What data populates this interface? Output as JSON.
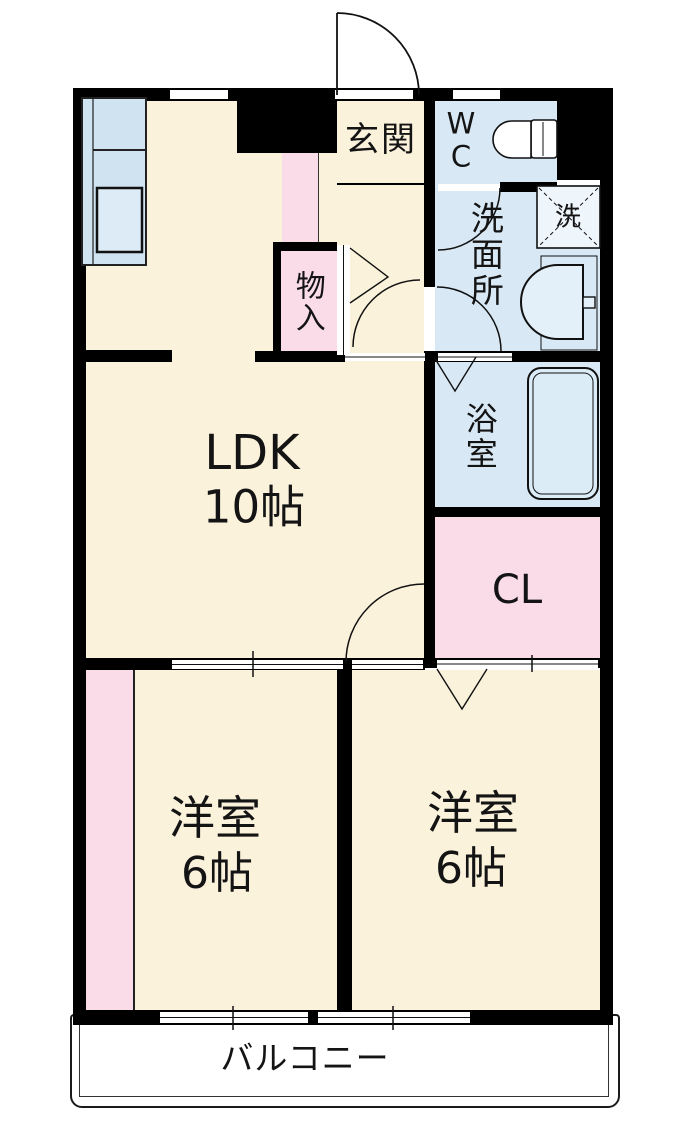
{
  "floorplan": {
    "rooms": {
      "genkan": {
        "label": "玄関"
      },
      "wc": {
        "label": "WC"
      },
      "senmenjo": {
        "label": "洗面所"
      },
      "yokushitsu": {
        "label": "浴室"
      },
      "monoire": {
        "label": "物入"
      },
      "ldk": {
        "label": "LDK",
        "size": "10帖"
      },
      "cl": {
        "label": "CL"
      },
      "bedroom_left": {
        "label": "洋室",
        "size": "6帖"
      },
      "bedroom_right": {
        "label": "洋室",
        "size": "6帖"
      },
      "balcony": {
        "label": "バルコニー"
      }
    },
    "fixtures": {
      "washing_machine": {
        "label": "洗"
      }
    },
    "colors": {
      "floor_cream": "#fbf2dc",
      "wet_area_blue": "#d8e9f5",
      "closet_pink": "#f9dce8",
      "counter_blue": "#cfe3f0",
      "wall_black": "#000000",
      "balcony_white": "#ffffff"
    }
  }
}
